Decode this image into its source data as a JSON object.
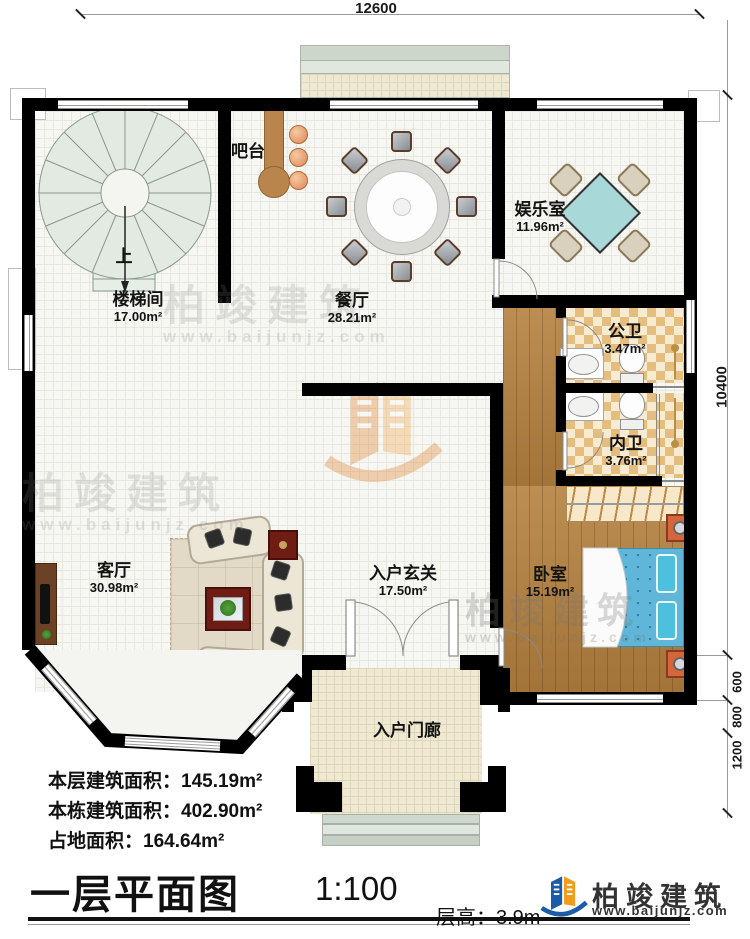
{
  "dimensions": {
    "top": "12600",
    "right_total": "10400",
    "seg_600": "600",
    "seg_800": "800",
    "seg_1200": "1200"
  },
  "rooms": {
    "stairwell": {
      "name": "楼梯间",
      "area": "17.00m²"
    },
    "bar": {
      "name": "吧台",
      "area": ""
    },
    "dining": {
      "name": "餐厅",
      "area": "28.21m²"
    },
    "game": {
      "name": "娱乐室",
      "area": "11.96m²"
    },
    "public_bath": {
      "name": "公卫",
      "area": "3.47m²"
    },
    "private_bath": {
      "name": "内卫",
      "area": "3.76m²"
    },
    "living": {
      "name": "客厅",
      "area": "30.98m²"
    },
    "foyer": {
      "name": "入户玄关",
      "area": "17.50m²"
    },
    "bedroom": {
      "name": "卧室",
      "area": "15.19m²"
    },
    "porch": {
      "name": "入户门廊",
      "area": ""
    }
  },
  "annotations": {
    "stairs_up": "上"
  },
  "info": {
    "line1_label": "本层建筑面积：",
    "line1_value": "145.19m²",
    "line2_label": "本栋建筑面积：",
    "line2_value": "402.90m²",
    "line3_label": "占地面积：",
    "line3_value": "164.64m²"
  },
  "title_block": {
    "title": "一层平面图",
    "scale": "1:100",
    "floor_height_label": "层高：",
    "floor_height_value": "3.9m"
  },
  "logo": {
    "name": "柏竣建筑",
    "url": "www.baijunjz.com"
  },
  "watermark": {
    "text": "柏竣建筑",
    "url": "www.baijunjz.com"
  },
  "colors": {
    "wall": "#000000",
    "wood": "#b5813f",
    "checker": "#e5bd7e",
    "bed": "#5fb6d8",
    "game_table": "#a8d8d8",
    "logo_blue": "#1a5ca8",
    "logo_orange": "#f09c1c"
  }
}
